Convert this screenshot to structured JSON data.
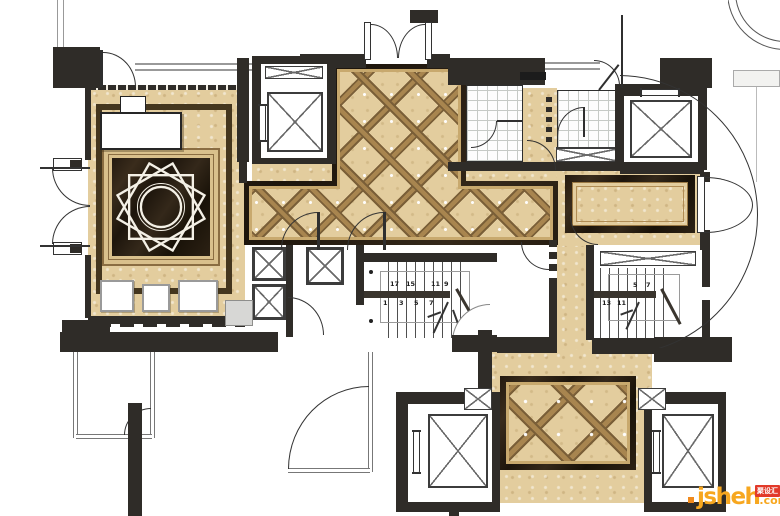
{
  "watermark": {
    "brand": "jsheh",
    "suffix": ".com",
    "badge_text": "聚设汇"
  },
  "stairs": {
    "center": {
      "top": [
        "17",
        "15",
        "11",
        "9"
      ],
      "bottom": [
        "1",
        "3",
        "5",
        "7"
      ]
    },
    "right": {
      "top": [
        "5",
        "7"
      ],
      "bottom": [
        "13",
        "11"
      ]
    }
  },
  "palette": {
    "floor_tan": "#e3cd9e",
    "inlay_band_brown": "#8a6d42",
    "marble_dark": "#241a0f",
    "wall_black": "#2f2c28",
    "gold_line": "#c8a96e",
    "grid_line": "#c6cac6",
    "watermark_orange": "#f7a71f",
    "badge_red": "#e23a2a"
  }
}
